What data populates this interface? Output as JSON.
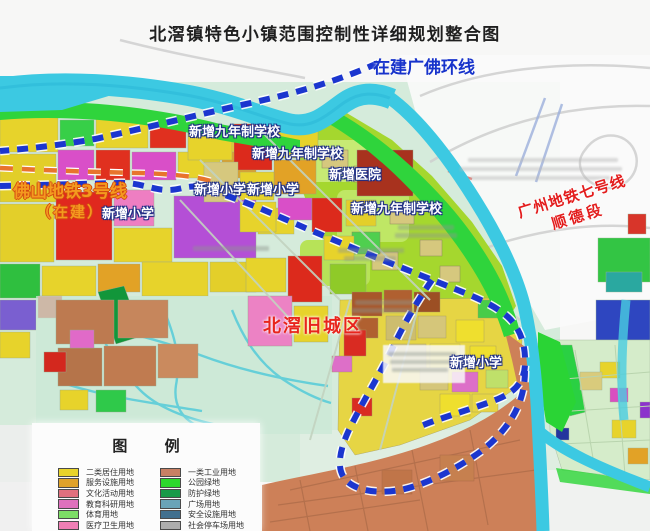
{
  "title": "北滘镇特色小镇范围控制性详细规划整合图",
  "colors": {
    "boundary_blue": "#1b36cf",
    "metro3_orange": "#f49a1f",
    "metro7_red": "#e31c1c",
    "river_cyan": "#3cc9e2",
    "oldtown_red": "#e8251c"
  },
  "map_labels": {
    "ring_line": "在建广佛环线",
    "metro3_line1": "佛山地铁3号线",
    "metro3_line2": "（在建）",
    "metro7_line1": "广州地铁七号线",
    "metro7_line2": "顺德段",
    "new_school_9yr_1": "新增九年制学校",
    "new_school_9yr_2": "新增九年制学校",
    "new_school_9yr_3": "新增九年制学校",
    "new_hospital": "新增医院",
    "new_primary_1": "新增小学",
    "new_primary_2": "新增小学",
    "new_primary_3": "新增小学",
    "new_primary_4": "新增小学",
    "old_town": "北滘旧城区"
  },
  "legend": {
    "title": "图 例",
    "left_items": [
      {
        "label": "二类居住用地",
        "color": "#e8d32a"
      },
      {
        "label": "服务设施用地",
        "color": "#dfa22a"
      },
      {
        "label": "文化活动用地",
        "color": "#e0707e"
      },
      {
        "label": "教育科研用地",
        "color": "#df71bd"
      },
      {
        "label": "体育用地",
        "color": "#7ddd66"
      },
      {
        "label": "医疗卫生用地",
        "color": "#ef7fb5"
      }
    ],
    "right_items": [
      {
        "label": "一类工业用地",
        "color": "#c88064"
      },
      {
        "label": "公园绿地",
        "color": "#2dd82d"
      },
      {
        "label": "防护绿地",
        "color": "#189a48"
      },
      {
        "label": "广场用地",
        "color": "#6aa4b8"
      },
      {
        "label": "安全设施用地",
        "color": "#41708f"
      },
      {
        "label": "社会停车场用地",
        "color": "#adadad"
      }
    ]
  }
}
